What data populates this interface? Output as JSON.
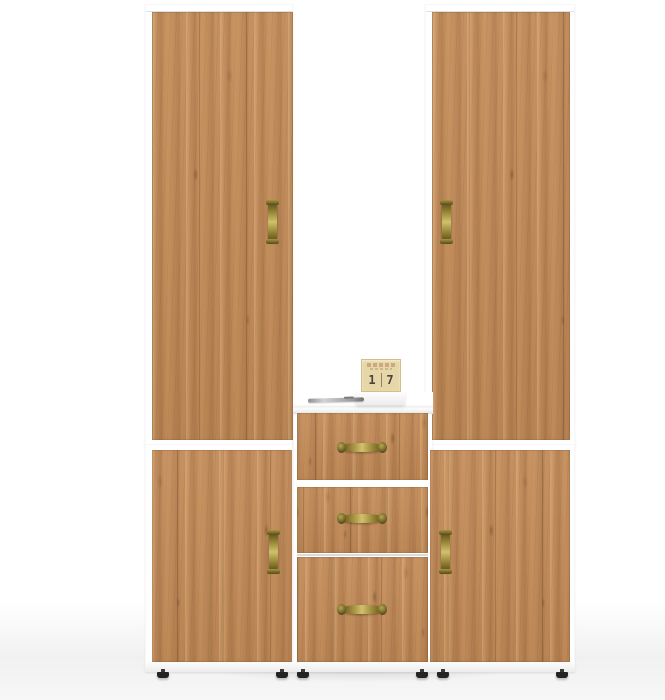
{
  "scene": {
    "kind": "product-photo",
    "subject": "hallway wardrobe set: two tall cabinets, two base cabinets, center chest with open shelf and three drawers",
    "finish": "golden oak doors on white carcass",
    "handle_style": "antique-brass"
  },
  "colors": {
    "wood_base": "#c38b58",
    "wood_light": "#dcae78",
    "wood_dark": "#9c6737",
    "carcass": "#ffffff",
    "edge_gray": "#e0e0e0",
    "seam_gray": "#bdbdbd",
    "brass_mid": "#8f7e30",
    "brass_light": "#d0c16b",
    "brass_dark": "#564a1a",
    "foot_black": "#232323",
    "pen_silver": "#b5b5b5",
    "floor": "#f1f1f1",
    "calendar_wood": "#e7d6a8",
    "calendar_text": "#4a453a"
  },
  "calendar": {
    "left_digit": "1",
    "right_digit": "7"
  },
  "components": {
    "doors": 4,
    "drawers": 3,
    "feet": 6,
    "shelf_items": "pen and wooden desk-calendar cube on stand"
  }
}
